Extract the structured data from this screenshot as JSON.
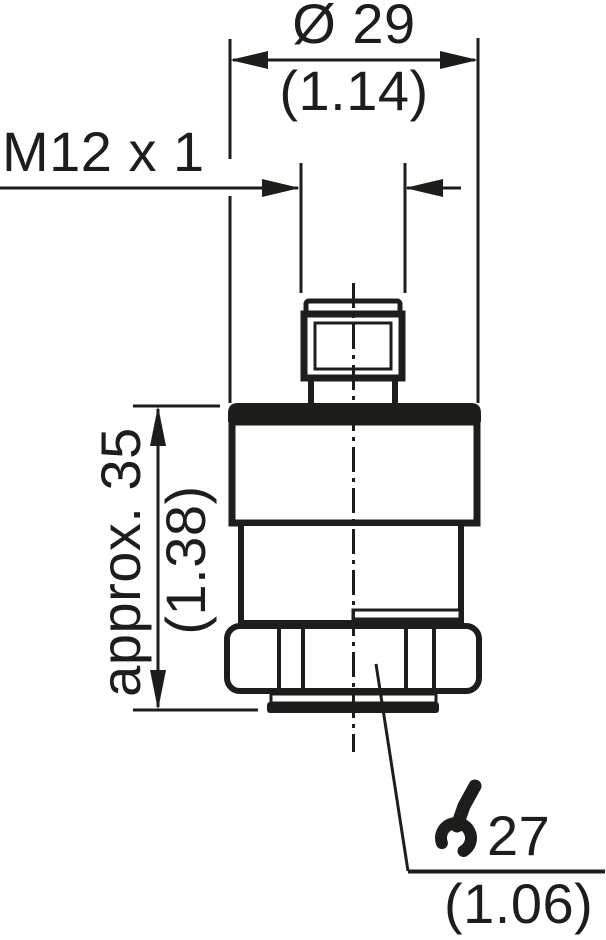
{
  "diagram": {
    "description": "Technical dimension drawing of a cylindrical sensor housing with M12 male connector and hex nut",
    "colors": {
      "line": "#1d1d1b",
      "background": "#ffffff",
      "fill": "#ffffff"
    },
    "top_dimension": {
      "metric": "Ø 29",
      "imperial": "(1.14)"
    },
    "thread_dimension": {
      "label": "M12 x 1"
    },
    "side_dimension": {
      "metric": "approx. 35",
      "imperial": "(1.38)"
    },
    "wrench_dimension": {
      "metric": "27",
      "imperial": "(1.06)",
      "icon": "wrench-icon"
    }
  }
}
